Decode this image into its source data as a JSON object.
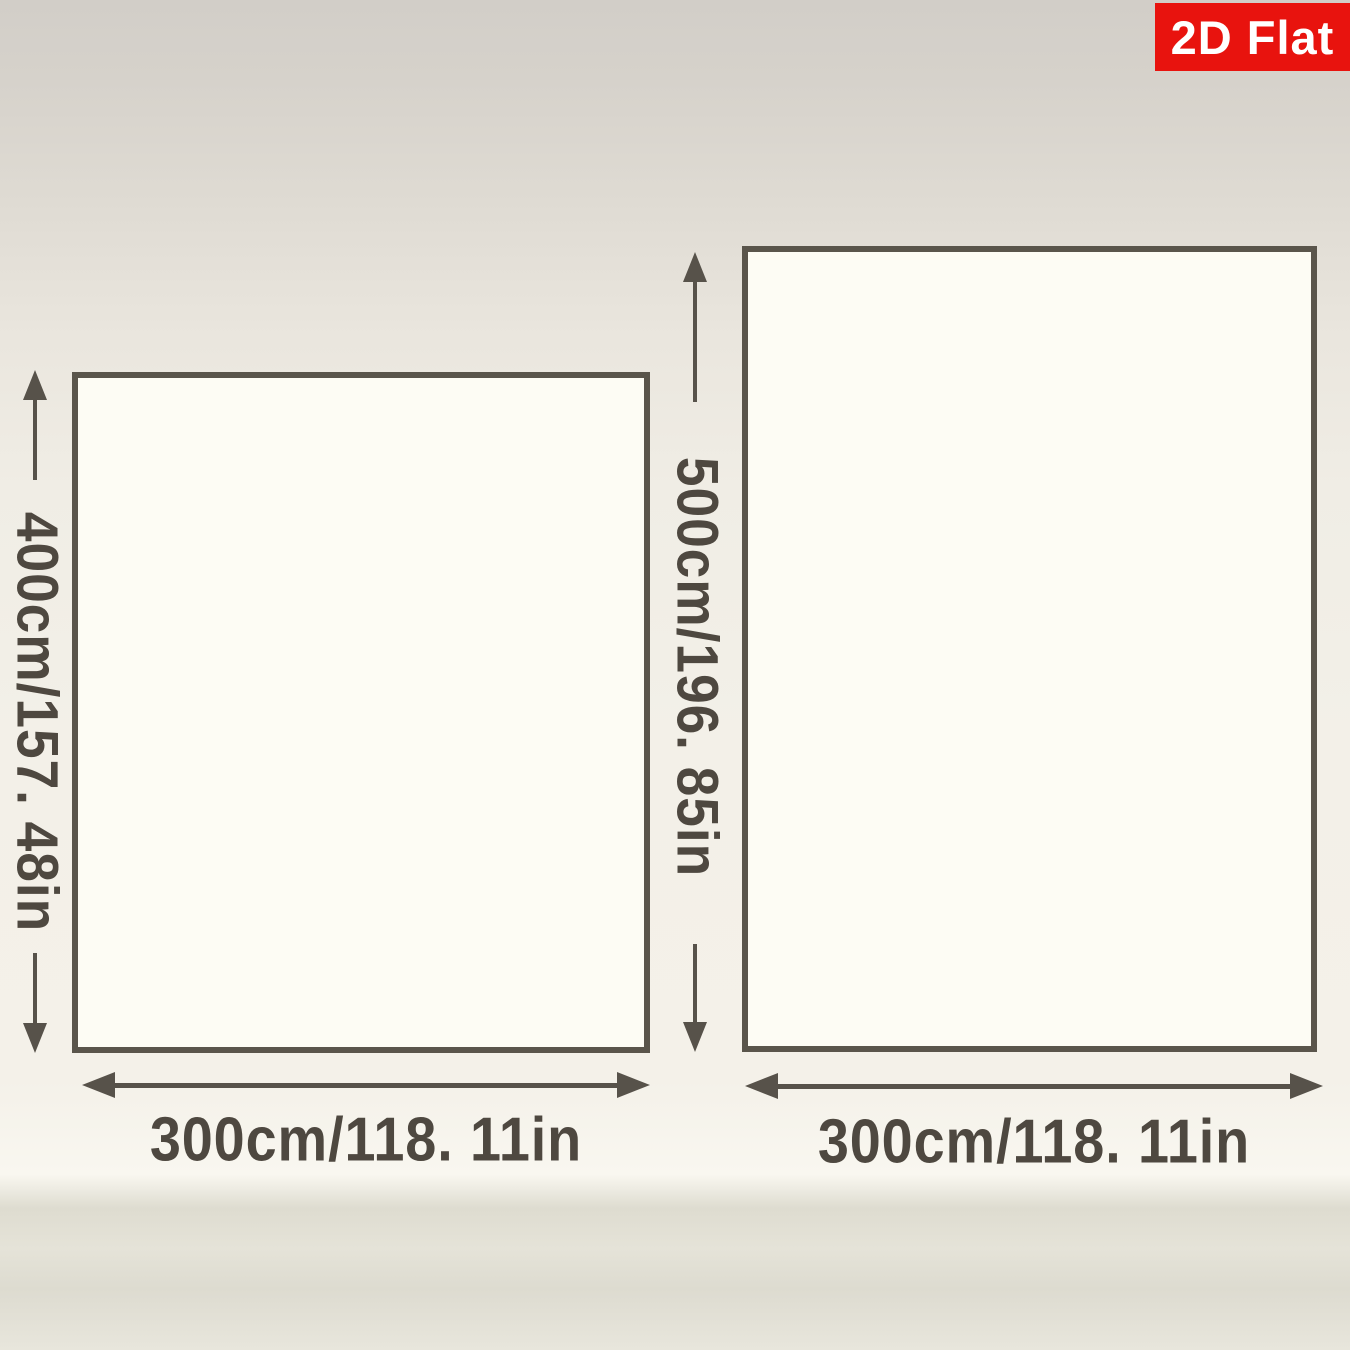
{
  "badge": {
    "label": "2D Flat",
    "background": "#e8130e",
    "text_color": "#ffffff"
  },
  "palette": {
    "line_color": "#57524a",
    "text_color": "#4e4840",
    "panel_fill": "#fdfcf4",
    "panel_border": "#5a554b"
  },
  "panels": [
    {
      "id": "left",
      "height_label": "400cm/157. 48in",
      "width_label": "300cm/118. 11in"
    },
    {
      "id": "right",
      "height_label": "500cm/196. 85in",
      "width_label": "300cm/118. 11in"
    }
  ]
}
